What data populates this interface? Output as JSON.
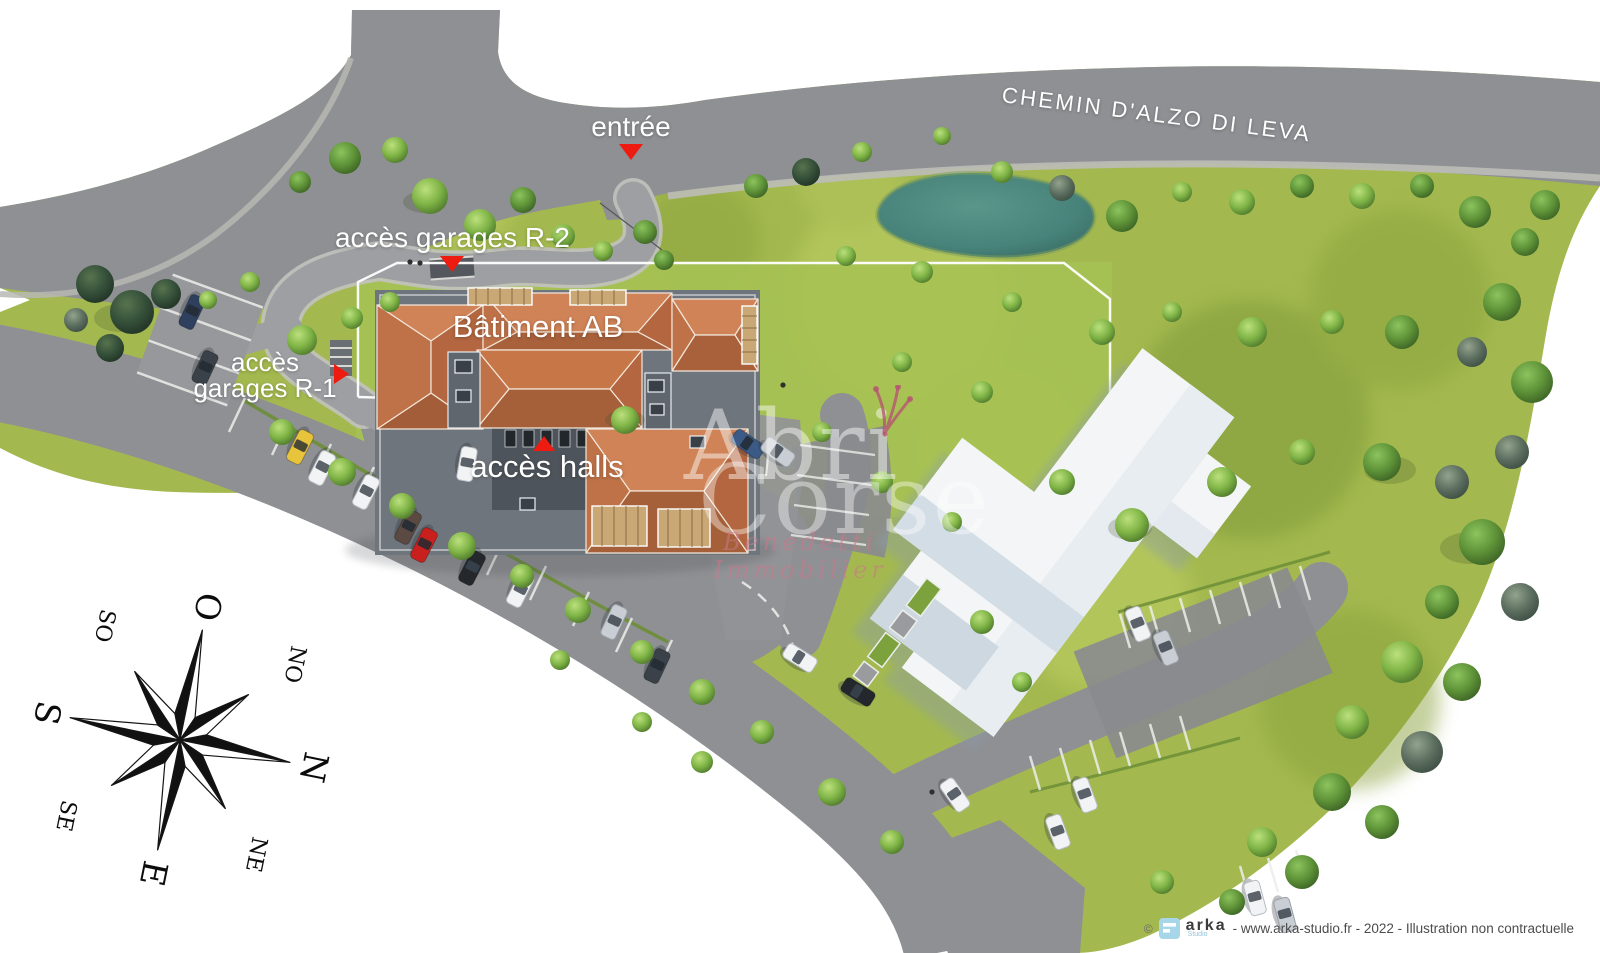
{
  "street": {
    "name": "CHEMIN D'ALZO DI LEVA"
  },
  "markers": {
    "entrance": {
      "label": "entrée"
    },
    "garages_r2": {
      "label": "accès garages R-2"
    },
    "garages_r1": {
      "label_line1": "accès",
      "label_line2": "garages R-1"
    },
    "halls": {
      "label": "accès halls"
    }
  },
  "building": {
    "name": "Bâtiment AB"
  },
  "compass": {
    "o": "O",
    "no": "NO",
    "n": "N",
    "ne": "NE",
    "e": "E",
    "se": "SE",
    "s": "S",
    "so": "SO"
  },
  "watermark": {
    "word1": "Abri",
    "word2": "Corse",
    "subtitle": "Benedetti Immobilier"
  },
  "credit": {
    "copyright": "©",
    "brand": "arka",
    "brand_sub": "Studio",
    "line": "- www.arka-studio.fr - 2022 - Illustration non contractuelle"
  },
  "colors": {
    "marker_red": "#ee1b10",
    "road_gray": "#8f9093",
    "grass_green": "#a2b84d",
    "roof_terracotta": "#c1734a",
    "pond_teal": "#47837a",
    "white_building": "#f3f5f6"
  }
}
